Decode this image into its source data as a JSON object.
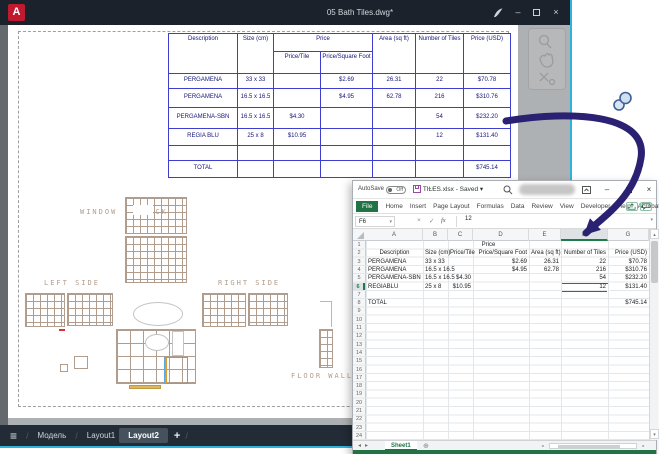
{
  "colors": {
    "accent_teal": "#2fb3dd",
    "excel_green": "#217346",
    "arrow_indigo": "#2a2173",
    "table_blue": "#3d3dd2",
    "cad_tan": "#b19d8e",
    "titlebar_dark": "#1b222c",
    "logo_red": "#c01a2f"
  },
  "autocad": {
    "titlebar": {
      "logo": "A",
      "title": "05 Bath Tiles.dwg*",
      "minimize": "–",
      "close": "×"
    },
    "nav_tabs": {
      "menu_glyph": "≡",
      "model": "Модель",
      "layout1": "Layout1",
      "layout2": "Layout2",
      "add": "+",
      "separator": "/"
    },
    "table": {
      "h_description": "Description",
      "h_size": "Size (cm)",
      "h_price": "Price",
      "h_price_tile": "Price/Tile",
      "h_price_sqft": "Price/Square Foot",
      "h_area": "Area (sq ft)",
      "h_tiles": "Number of Tiles",
      "h_price_usd": "Price (USD)",
      "rows": [
        {
          "d": "PERGAMENA",
          "s": "33 x 33",
          "pt": "",
          "ps": "$2.69",
          "a": "26.31",
          "n": "22",
          "p": "$70.78"
        },
        {
          "d": "PERGAMENA",
          "s": "16.5 x 16.5",
          "pt": "",
          "ps": "$4.95",
          "a": "62.78",
          "n": "216",
          "p": "$310.76"
        },
        {
          "d": "PERGAMENA-SBN",
          "s": "16.5 x 16.5",
          "pt": "$4.30",
          "ps": "",
          "a": "",
          "n": "54",
          "p": "$232.20"
        },
        {
          "d": "REGIA BLU",
          "s": "25 x 8",
          "pt": "$10.95",
          "ps": "",
          "a": "",
          "n": "12",
          "p": "$131.40"
        },
        {
          "d": "",
          "s": "",
          "pt": "",
          "ps": "",
          "a": "",
          "n": "",
          "p": ""
        },
        {
          "d": "TOTAL",
          "s": "",
          "pt": "",
          "ps": "",
          "a": "",
          "n": "",
          "p": "$745.14"
        }
      ]
    },
    "drawing": {
      "label_window": "WINDOW",
      "label_back": "BACK",
      "label_left": "LEFT SIDE",
      "label_right": "RIGHT SIDE",
      "label_floor_wall": "FLOOR  WALL"
    }
  },
  "excel": {
    "titlebar": {
      "autosave_label": "AutoSave",
      "autosave_state": "Off",
      "dots": "⋯",
      "title": "TILES.xlsx - Saved ▾",
      "minimize": "–",
      "close": "×"
    },
    "ribbon": {
      "tabs": [
        "File",
        "Home",
        "Insert",
        "Page Layout",
        "Formulas",
        "Data",
        "Review",
        "View",
        "Developer",
        "Help",
        "Acrobat"
      ]
    },
    "formula_bar": {
      "name_box": "F6",
      "name_dd": "▾",
      "cancel": "×",
      "check": "✓",
      "fx": "fx",
      "value": "12",
      "expand": "▾"
    },
    "columns": [
      "A",
      "B",
      "C",
      "D",
      "E",
      "F",
      "G"
    ],
    "selected_column": "F",
    "selected_row": "6",
    "row_numbers": [
      "1",
      "2",
      "3",
      "4",
      "5",
      "6",
      "7",
      "8",
      "9",
      "10",
      "11",
      "12",
      "13",
      "14",
      "15",
      "16",
      "17",
      "18",
      "19",
      "20",
      "21",
      "22",
      "23",
      "24"
    ],
    "sheet": {
      "r1": {
        "price_merged": "Price"
      },
      "r2": {
        "a": "Description",
        "b": "Size (cm)",
        "c": "Price/Tile",
        "d": "Price/Square Foot",
        "e": "Area (sq ft)",
        "f": "Number of Tiles",
        "g": "Price (USD)"
      },
      "r3": {
        "a": "PERGAMENA",
        "b": "33 x 33",
        "d": "$2.69",
        "e": "26.31",
        "f": "22",
        "g": "$70.78"
      },
      "r4": {
        "a": "PERGAMENA",
        "b": "16.5 x 16.5",
        "d": "$4.95",
        "e": "62.78",
        "f": "216",
        "g": "$310.76"
      },
      "r5": {
        "a": "PERGAMENA-SBN",
        "b": "16.5 x 16.5",
        "c": "$4.30",
        "f": "54",
        "g": "$232.20"
      },
      "r6": {
        "a": "REGIABLU",
        "b": "25 x 8",
        "c": "$10.95",
        "f": "12",
        "g": "$131.40"
      },
      "r8": {
        "a": "TOTAL",
        "g": "$745.14"
      }
    },
    "sheet_tabs": {
      "prev": "◂",
      "next": "▸",
      "name": "Sheet1",
      "add": "⊕"
    },
    "scroll": {
      "up": "▴",
      "down": "▾",
      "left": "◂",
      "right": "▸"
    }
  }
}
